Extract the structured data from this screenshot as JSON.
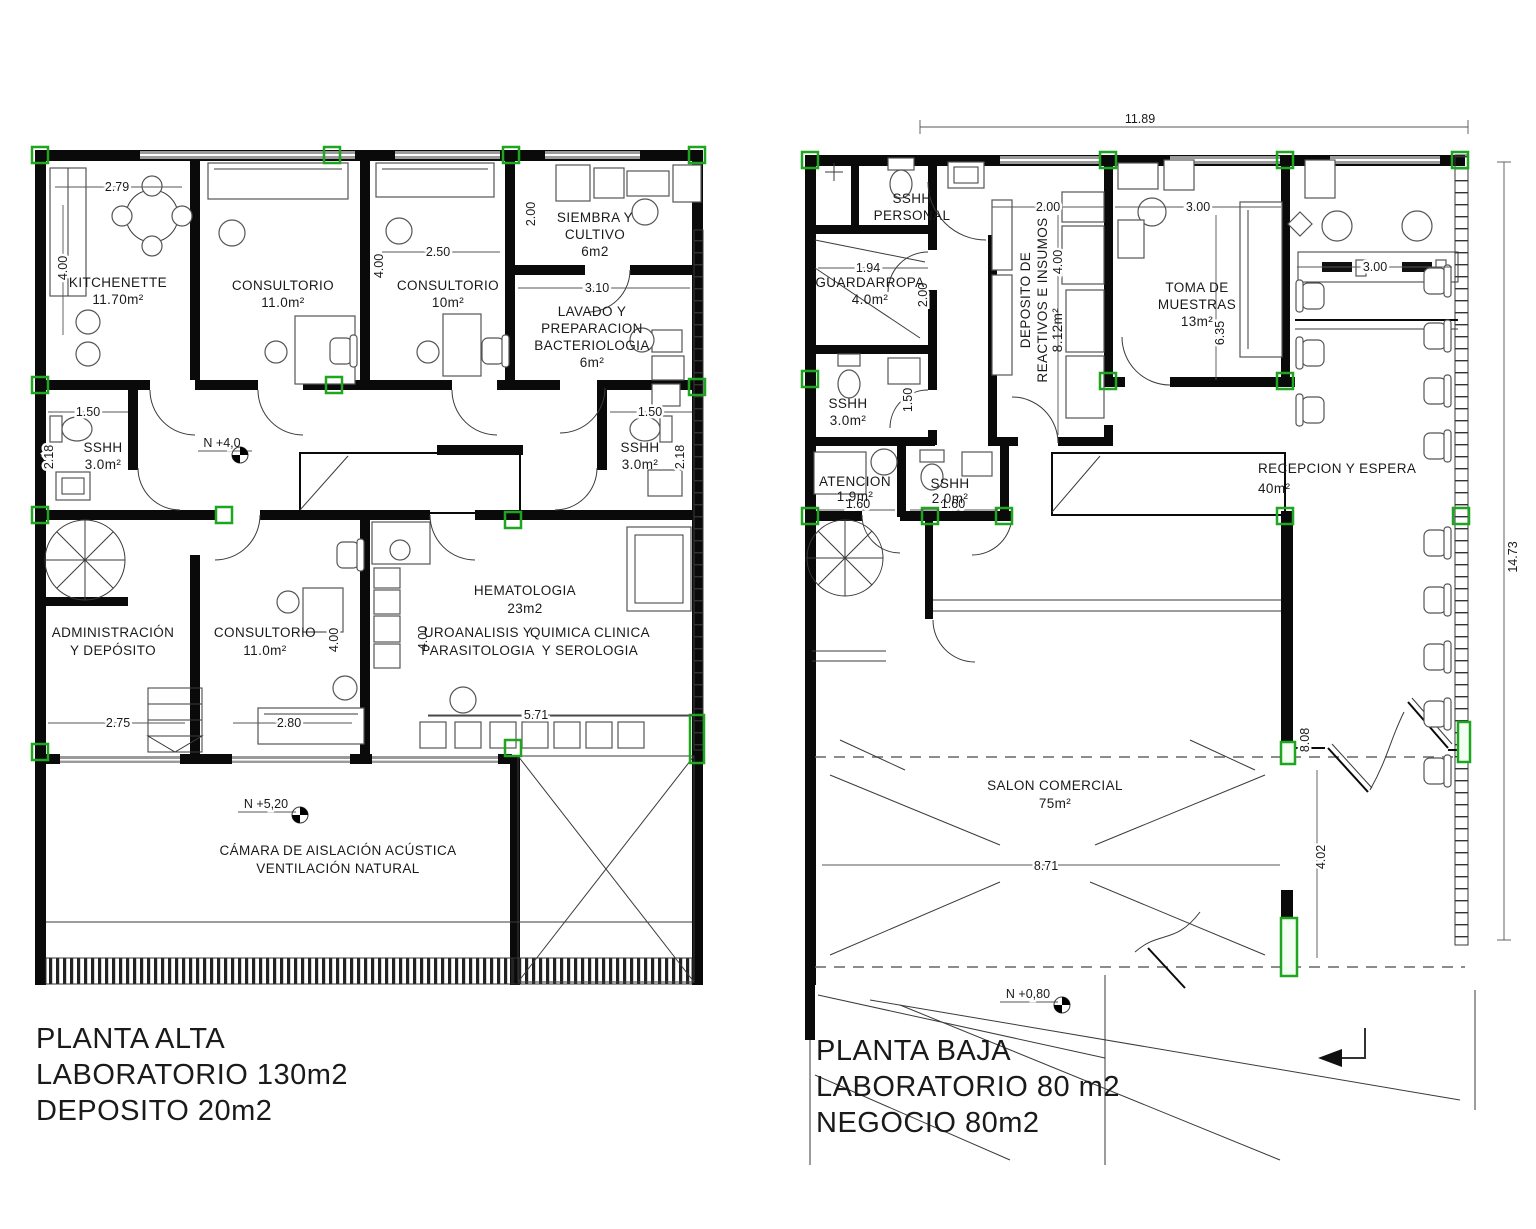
{
  "alta": {
    "title": [
      "PLANTA ALTA",
      "LABORATORIO 130m2",
      "DEPOSITO 20m2"
    ],
    "rooms": [
      [
        "KITCHENETTE",
        "11.70m²"
      ],
      [
        "CONSULTORIO",
        "11.0m²"
      ],
      [
        "CONSULTORIO",
        "10m²"
      ],
      [
        "SIEMBRA Y",
        "CULTIVO",
        "6m2"
      ],
      [
        "LAVADO Y",
        "PREPARACION",
        "BACTERIOLOGIA",
        "6m²"
      ],
      [
        "SSHH",
        "3.0m²"
      ],
      [
        "SSHH",
        "3.0m²"
      ],
      [
        "ADMINISTRACIÓN",
        "Y DEPÓSITO"
      ],
      [
        "CONSULTORIO",
        "11.0m²"
      ],
      [
        "HEMATOLOGIA",
        "23m2"
      ],
      [
        "UROANALISIS Y",
        "PARASITOLOGIA"
      ],
      [
        "QUIMICA CLINICA",
        "Y SEROLOGIA"
      ],
      [
        "CÁMARA DE AISLACIÓN ACÚSTICA",
        "VENTILACIÓN NATURAL"
      ]
    ],
    "dims": [
      "2.79",
      "4.00",
      "2.50",
      "4.00",
      "2.00",
      "3.10",
      "1.50",
      "2.18",
      "1.50",
      "2.18",
      "4.00",
      "4.00",
      "2.75",
      "2.80",
      "5.71"
    ],
    "levels": [
      "N +4,0",
      "N +5,20"
    ]
  },
  "baja": {
    "title": [
      "PLANTA BAJA",
      "LABORATORIO 80 m2",
      "NEGOCIO 80m2"
    ],
    "rooms": [
      [
        "SSHH",
        "PERSONAL"
      ],
      [
        "GUARDARROPA",
        "4.0m²"
      ],
      [
        "SSHH",
        "3.0m²"
      ],
      [
        "DEPOSITO DE",
        "REACTIVOS E INSUMOS",
        "8.12m²"
      ],
      [
        "TOMA DE",
        "MUESTRAS",
        "13m²"
      ],
      [
        "RECEPCION Y ESPERA",
        "40m²"
      ],
      [
        "ATENCION",
        "1.9m²"
      ],
      [
        "SSHH",
        "2.0m²"
      ],
      [
        "SALON COMERCIAL",
        "75m²"
      ]
    ],
    "dims": [
      "11.89",
      "1.94",
      "2.00",
      "1.50",
      "2.00",
      "4.00",
      "3.00",
      "6.35",
      "3.00",
      "14.73",
      "1.60",
      "1.60",
      "8.71",
      "8.08",
      "4.02"
    ],
    "levels": [
      "N +0,80"
    ]
  }
}
